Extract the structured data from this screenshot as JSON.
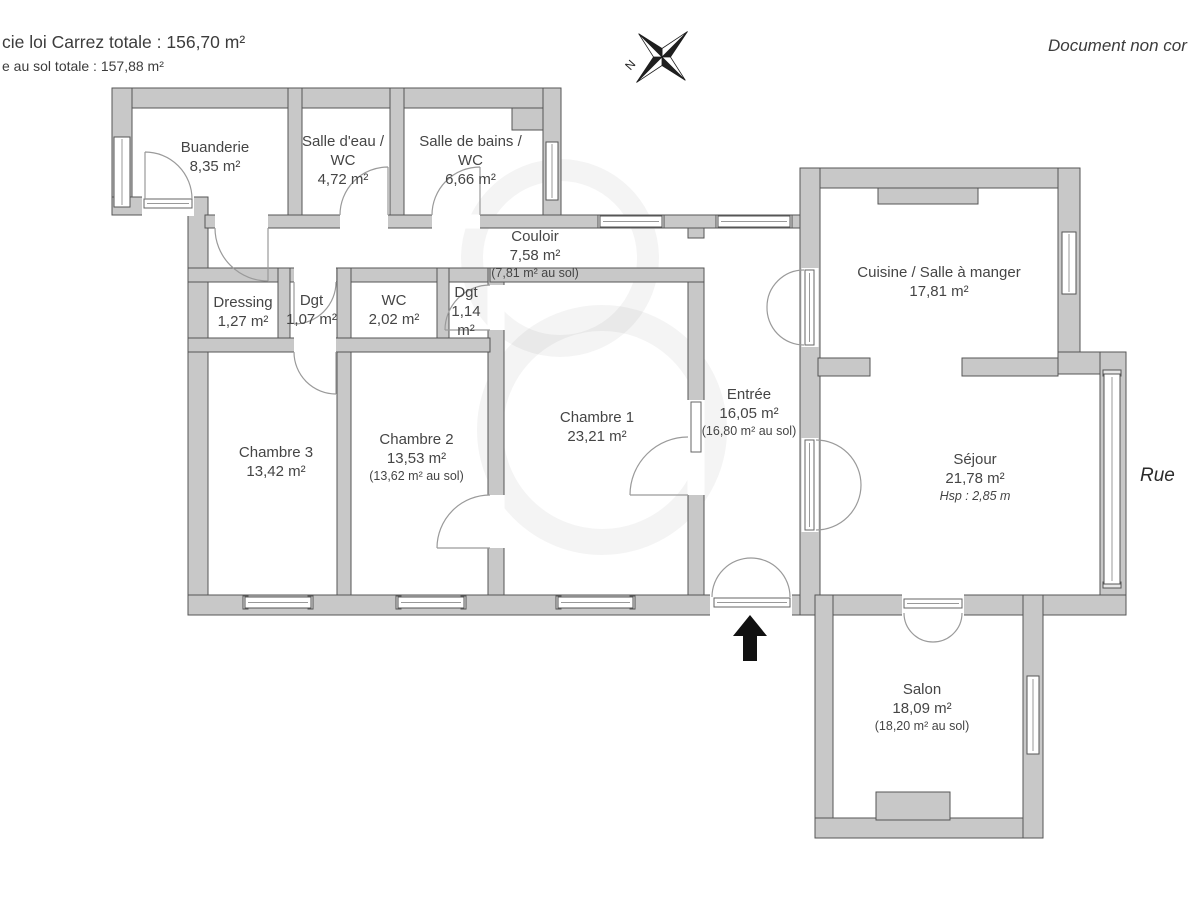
{
  "header": {
    "carrez_line": "cie loi Carrez totale :  156,70 m²",
    "floor_line": "e au sol totale :  157,88 m²",
    "disclaimer": "Document non cor",
    "street_label": "Rue",
    "compass_label": "N"
  },
  "colors": {
    "wall_fill": "#c8c8c8",
    "wall_stroke": "#565656",
    "arc_stroke": "#9a9a9a",
    "text": "#454545"
  },
  "rooms": [
    {
      "name": "Buanderie",
      "area": "8,35 m²"
    },
    {
      "name_lines": [
        "Salle d'eau /",
        "WC"
      ],
      "area": "4,72 m²"
    },
    {
      "name_lines": [
        "Salle de bains /",
        "WC"
      ],
      "area": "6,66 m²"
    },
    {
      "name": "Couloir",
      "area": "7,58 m²",
      "floor_area": "(7,81 m² au sol)"
    },
    {
      "name": "Dressing",
      "area": "1,27 m²"
    },
    {
      "name": "Dgt",
      "area": "1,07 m²"
    },
    {
      "name": "WC",
      "area": "2,02 m²"
    },
    {
      "name": "Dgt",
      "area": "1,14 m²"
    },
    {
      "name": "Chambre 3",
      "area": "13,42 m²"
    },
    {
      "name": "Chambre 2",
      "area": "13,53 m²",
      "floor_area": "(13,62 m² au sol)"
    },
    {
      "name": "Chambre 1",
      "area": "23,21 m²"
    },
    {
      "name": "Entrée",
      "area": "16,05 m²",
      "floor_area": "(16,80 m² au sol)"
    },
    {
      "name": "Cuisine / Salle à manger",
      "area": "17,81 m²"
    },
    {
      "name": "Séjour",
      "area": "21,78 m²",
      "ceiling": "Hsp : 2,85 m"
    },
    {
      "name": "Salon",
      "area": "18,09 m²",
      "floor_area": "(18,20 m² au sol)"
    }
  ]
}
